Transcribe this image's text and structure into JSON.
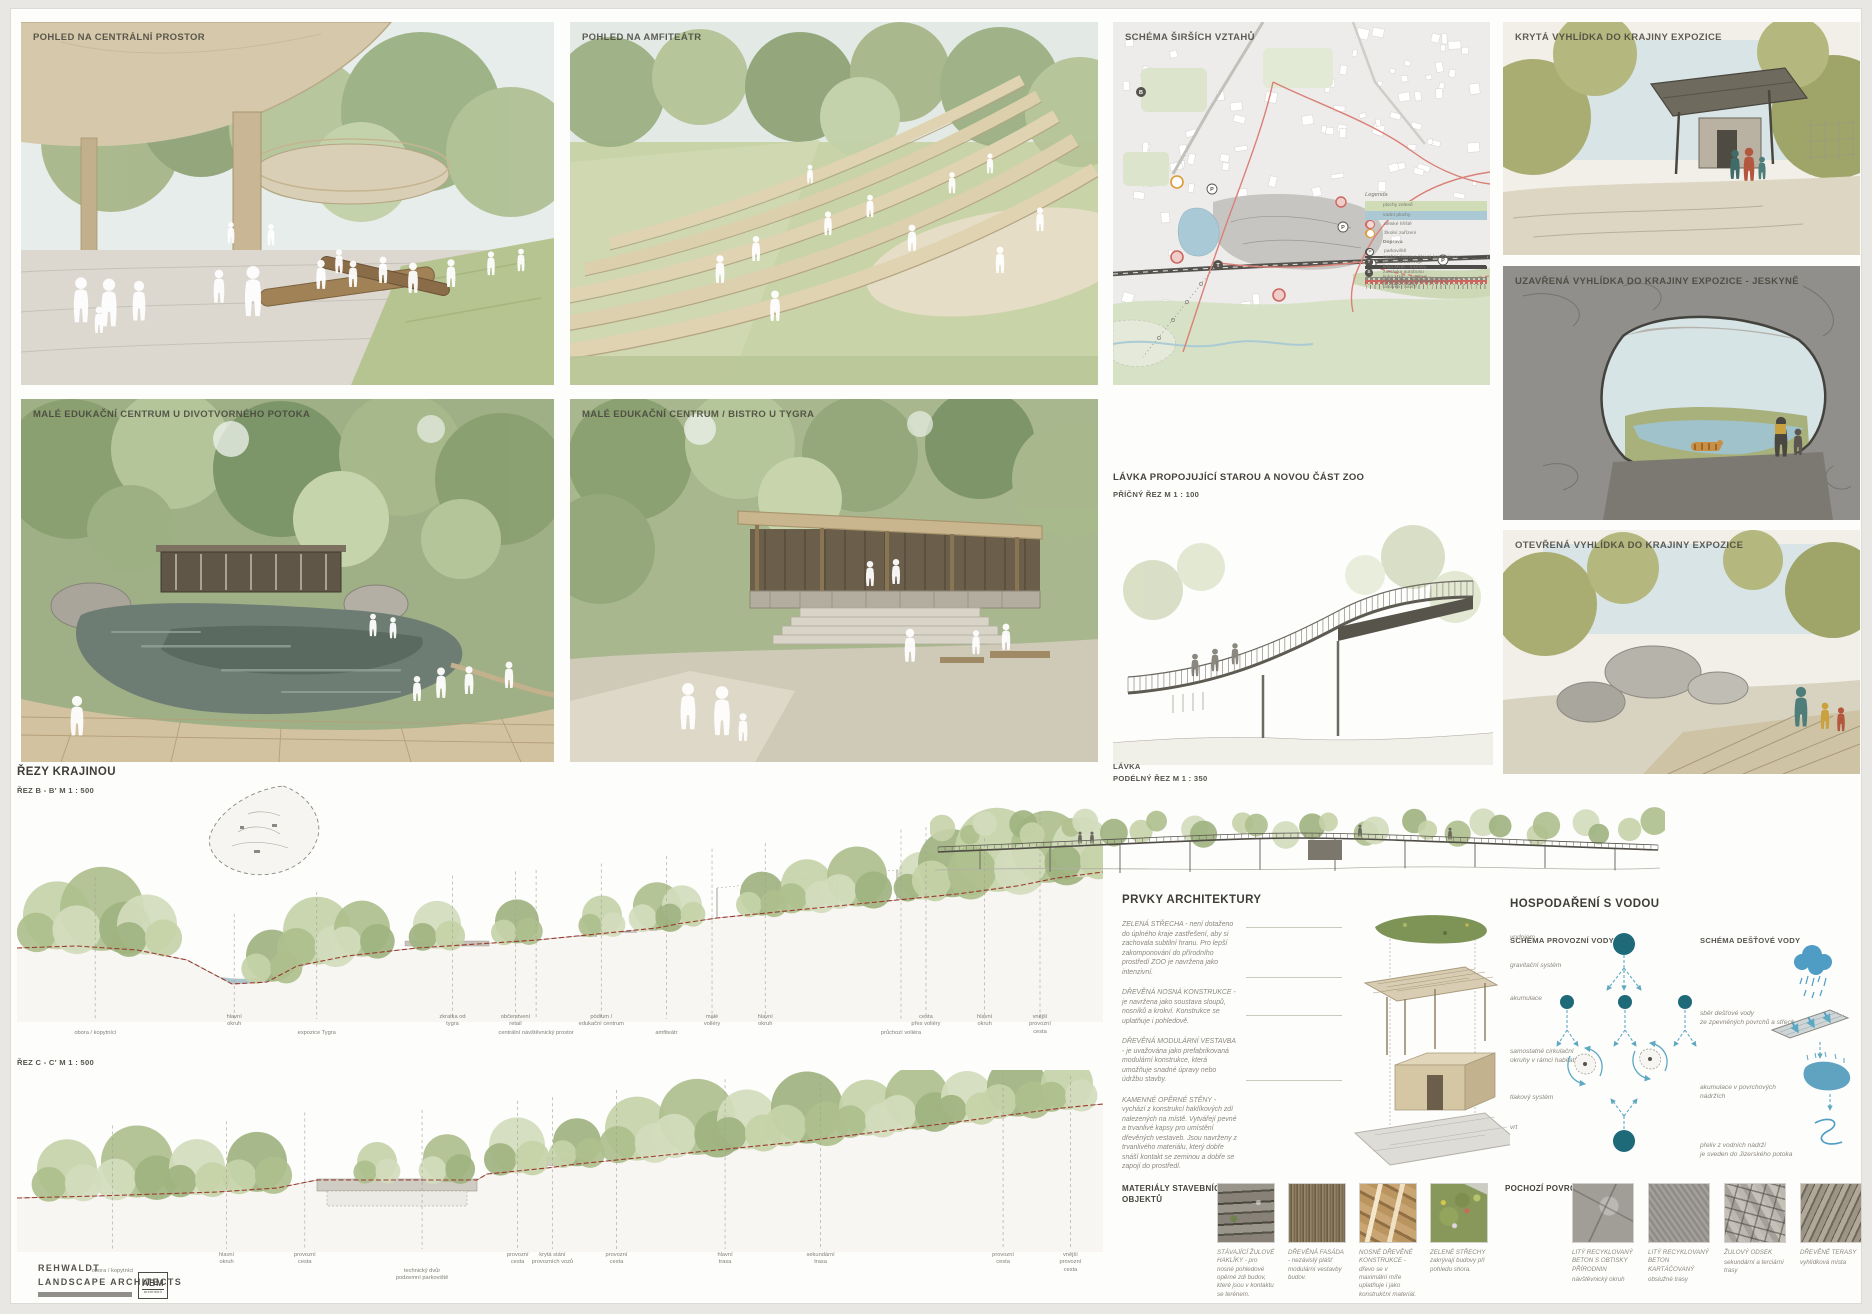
{
  "panels": {
    "central": {
      "title": "POHLED NA CENTRÁLNÍ PROSTOR"
    },
    "amphitheater": {
      "title": "POHLED NA AMFITEÁTR"
    },
    "edu_pond": {
      "title": "MALÉ EDUKAČNÍ CENTRUM U DIVOTVORNÉHO POTOKA"
    },
    "edu_bistro": {
      "title": "MALÉ EDUKAČNÍ CENTRUM / BISTRO U TYGRA"
    },
    "lookout_covered": {
      "title": "KRYTÁ VYHLÍDKA DO KRAJINY EXPOZICE"
    },
    "lookout_cave": {
      "title": "UZAVŘENÁ VYHLÍDKA DO KRAJINY EXPOZICE - JESKYNĚ"
    },
    "lookout_open": {
      "title": "OTEVŘENÁ VYHLÍDKA DO KRAJINY EXPOZICE"
    }
  },
  "map": {
    "title": "SCHÉMA ŠIRŠÍCH VZTAHŮ",
    "legend_title": "Legenda",
    "badge_letters": {
      "p": "P",
      "t": "T",
      "b": "B"
    },
    "legend": [
      {
        "sw": "sw-green",
        "label": "plochy zeleně"
      },
      {
        "sw": "sw-blue",
        "label": "vodní plochy"
      },
      {
        "sw": "sw-ring-red",
        "label": "dětské hřiště"
      },
      {
        "sw": "sw-ring-orange",
        "label": "Školní zařízení"
      },
      {
        "sw": "sw-head",
        "label": "Doprava"
      },
      {
        "sw": "sw-badge-light",
        "sym": "P",
        "label": "parkoviště"
      },
      {
        "sw": "sw-line-dark",
        "label": "osobní doprava-hlavní komunikace"
      },
      {
        "sw": "sw-badge-dark",
        "sym": "T",
        "label": "zastávka tramvaje"
      },
      {
        "sw": "sw-line-tram",
        "label": "linka MHD - tramvaj"
      },
      {
        "sw": "sw-badge-dark",
        "sym": "B",
        "label": "zastávka autobusu"
      },
      {
        "sw": "sw-line-bus",
        "label": "linka MHD - autobus"
      },
      {
        "sw": "sw-line-busdash",
        "label": "linka MHD - autobus - navrhované"
      },
      {
        "sw": "sw-line-red",
        "label": "cyklostezky / cyklotrasy"
      },
      {
        "sw": "sw-line-reddash",
        "label": "návrh pěších/cyklistických tras"
      },
      {
        "sw": "sw-line-dots",
        "label": "turistické stezky"
      },
      {
        "sw": "sw-line-circles",
        "label": "lanovka - návrh"
      }
    ]
  },
  "bridge_cross": {
    "title": "LÁVKA PROPOJUJÍCÍ STAROU A NOVOU ČÁST ZOO",
    "subtitle": "PŘÍČNÝ ŘEZ   M 1 : 100"
  },
  "bridge_long": {
    "title": "LÁVKA",
    "subtitle": "PODÉLNÝ ŘEZ M      1 : 350"
  },
  "sections": {
    "title": "ŘEZY KRAJINOU",
    "b": {
      "label": "ŘEZ B - B'  M 1 : 500",
      "labels": [
        {
          "x": 7.2,
          "row": 2,
          "text": "obora / kopytníci"
        },
        {
          "x": 20.0,
          "row": 1,
          "text": "hlavní\nokruh"
        },
        {
          "x": 27.6,
          "row": 2,
          "text": "expozice Tygra"
        },
        {
          "x": 40.1,
          "row": 1,
          "text": "zkratka od\ntygra"
        },
        {
          "x": 45.9,
          "row": 1,
          "text": "občerstvení\nretail"
        },
        {
          "x": 47.8,
          "row": 2,
          "text": "centrální návštěvnický prostor"
        },
        {
          "x": 53.8,
          "row": 1,
          "text": "pódium /\nedukační centrum"
        },
        {
          "x": 59.8,
          "row": 2,
          "text": "amfiteátr"
        },
        {
          "x": 64.0,
          "row": 1,
          "text": "malé\nvoliéry"
        },
        {
          "x": 68.9,
          "row": 1,
          "text": "hlavní\nokruh"
        },
        {
          "x": 81.4,
          "row": 2,
          "text": "průchozí voliéra"
        },
        {
          "x": 83.7,
          "row": 1,
          "text": "cesta\npřes voliéry"
        },
        {
          "x": 89.1,
          "row": 1,
          "text": "hlavní\nokruh"
        },
        {
          "x": 94.2,
          "row": 1,
          "text": "vnější\nprovozní\ncesta"
        }
      ]
    },
    "c": {
      "label": "ŘEZ C - C'  M 1 : 500",
      "labels": [
        {
          "x": 8.8,
          "row": 2,
          "text": "obora / kopytníci"
        },
        {
          "x": 19.3,
          "row": 1,
          "text": "hlavní\nokruh"
        },
        {
          "x": 26.5,
          "row": 1,
          "text": "provozní\ncesta"
        },
        {
          "x": 37.3,
          "row": 2,
          "text": "technický dvůr\npodzemní parkoviště"
        },
        {
          "x": 46.1,
          "row": 1,
          "text": "provozní\ncesta"
        },
        {
          "x": 49.3,
          "row": 1,
          "text": "krytá stání\nprovozních vozů"
        },
        {
          "x": 55.2,
          "row": 1,
          "text": "provozní\ncesta"
        },
        {
          "x": 65.2,
          "row": 1,
          "text": "hlavní\ntrasa"
        },
        {
          "x": 74.0,
          "row": 1,
          "text": "sekundární\ntrasa"
        },
        {
          "x": 90.8,
          "row": 1,
          "text": "provozní\ncesta"
        },
        {
          "x": 97.0,
          "row": 1,
          "text": "vnější\nprovozní\ncesta"
        }
      ]
    }
  },
  "architecture": {
    "title": "PRVKY ARCHITEKTURY",
    "paragraphs": [
      {
        "text": "ZELENÁ STŘECHA - není dotaženo do úplného kraje zastřešení, aby si zachovala subtilní hranu. Pro lepší zakomponování do přírodního prostředí ZOO je navržena jako intenzivní."
      },
      {
        "text": "DŘEVĚNÁ NOSNÁ KONSTRUKCE - je navržena jako soustava sloupů, nosníků a krokví. Konstrukce se uplatňuje i pohledově."
      },
      {
        "text": "DŘEVĚNÁ MODULÁRNÍ VESTAVBA - je uvažována jako prefabrikovaná modulární konstrukce, která umožňuje snadné úpravy nebo údržbu stavby."
      },
      {
        "text": "KAMENNÉ OPĚRNÉ STĚNY - vychází z konstrukcí haklíkových zdí nalezených na místě. Vytvářejí pevné a trvanlivé kapsy pro umístění dřevěných vestaveb. Jsou navrženy z trvanlivého materiálu, který dobře snáší kontakt se zeminou a dobře se zapojí do prostředí."
      }
    ]
  },
  "water": {
    "title": "HOSPODAŘENÍ S VODOU",
    "accent": "#1e6a78",
    "arrow": "#5fa8c2",
    "left": {
      "title": "SCHÉMA PROVOZNÍ VODY",
      "labels": [
        {
          "top": 36,
          "text": "vodojem"
        },
        {
          "top": 64,
          "text": "gravitační systém"
        },
        {
          "top": 97,
          "text": "akumulace"
        },
        {
          "top": 150,
          "text": "samostatné cirkulační\nokruhy v rámci habitatů"
        },
        {
          "top": 196,
          "text": "tlakový systém"
        },
        {
          "top": 226,
          "text": "vrt"
        }
      ]
    },
    "right": {
      "title": "SCHÉMA DEŠŤOVÉ  VODY",
      "labels": [
        {
          "top": 112,
          "text": "sběr dešťové vody\nze zpevněných povrchů a střech"
        },
        {
          "top": 186,
          "text": "akumulace v povrchových nádržích"
        },
        {
          "top": 244,
          "text": "přeliv z vodních nádrží\nje sveden do Jizerského potoka"
        }
      ]
    }
  },
  "materials": {
    "title": "MATERIÁLY STAVEBNÍCH\nOBJEKTŮ",
    "items": [
      {
        "tex": "tex-granite",
        "caption": "STÁVAJÍCÍ ŽULOVÉ HAKLÍKY - pro nosné pohledové opěrné zdi budov, které jsou v kontaktu se terénem."
      },
      {
        "tex": "tex-woodfacade",
        "caption": "DŘEVĚNÁ FASÁDA - nezávislý plášť modulární vestavby budov."
      },
      {
        "tex": "tex-timber",
        "caption": "NOSNÉ DŘEVĚNÉ KONSTRUKCE - dřevo se v maximální míře uplatňuje i jako konstrukční materiál."
      },
      {
        "tex": "tex-greenroof",
        "caption": "ZELENÉ STŘECHY zakrývají budovy při pohledu shora."
      }
    ]
  },
  "surfaces": {
    "title": "POCHOZÍ POVRCHY",
    "items": [
      {
        "tex": "tex-conc-stamp",
        "caption": "LITÝ RECYKLOVANÝ BETON S OBTISKY PŘÍRODNIN",
        "sub": "návštěvnický okruh"
      },
      {
        "tex": "tex-conc-brush",
        "caption": "LITÝ RECYKLOVANÝ BETON KARTÁČOVANÝ",
        "sub": "obslužné trasy"
      },
      {
        "tex": "tex-setts",
        "caption": "ŽULOVÝ ODSEK",
        "sub": "sekundární a terciární trasy"
      },
      {
        "tex": "tex-deck",
        "caption": "DŘEVĚNÉ TERASY",
        "sub": "vyhlídková místa"
      }
    ]
  },
  "credits": {
    "studio": "REHWALDT\nLANDSCAPE ARCHITECTS",
    "partner": "ABM",
    "partner_sub": "architekti"
  }
}
